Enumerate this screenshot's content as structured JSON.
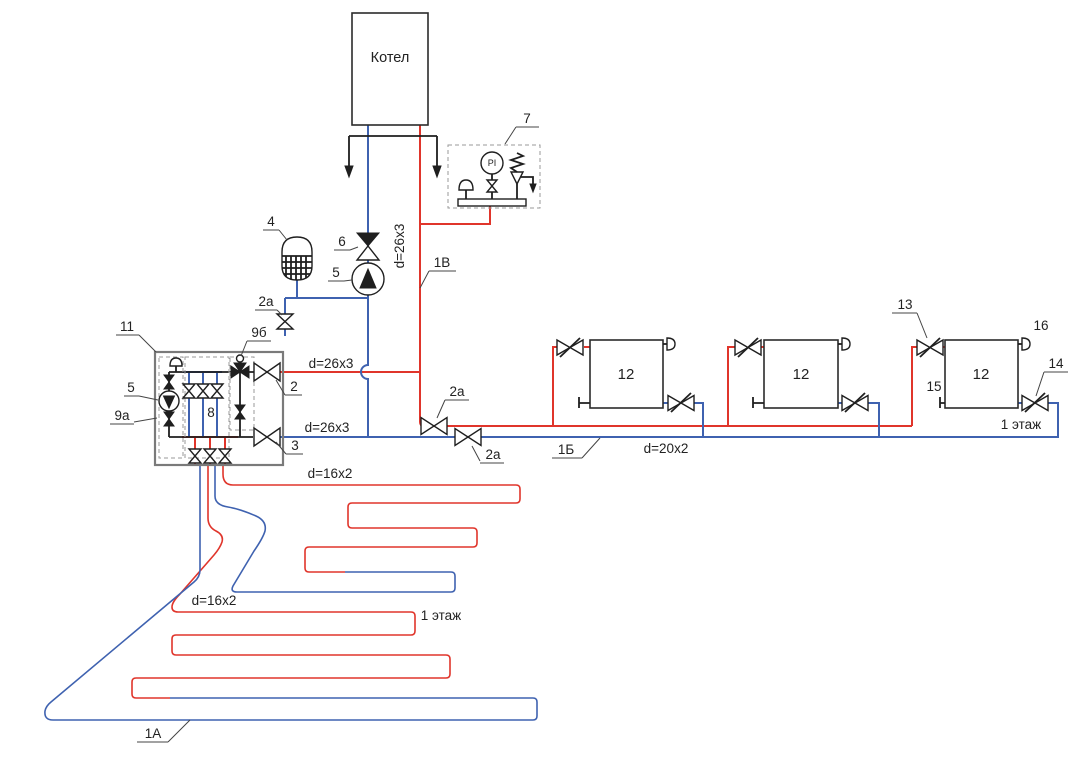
{
  "diagram_title": "Схема отопления с котлом, радиаторами и тёплым полом",
  "colors": {
    "supply_red": "#e0352b",
    "return_blue": "#3f62b0",
    "line_black": "#1f1f1f",
    "box_gray": "#7a7a7a"
  },
  "boiler": {
    "label": "Котел"
  },
  "safety_group": {
    "ref": "7",
    "gauge_label": "PI"
  },
  "equipment": {
    "expansion_tank": "4",
    "check_valve": "6",
    "pump": "5",
    "drain_valve": "2а",
    "mixing_unit": "11",
    "pump_group": "9а",
    "mixing_valve": "9б",
    "manifold": "8",
    "supply_shutoff": "2",
    "return_shutoff": "3",
    "radiator": "12",
    "radiator_supply_valve": "13",
    "radiator_return_valve": "14",
    "radiator_plug": "15",
    "radiator_air_vent": "16"
  },
  "line_refs": {
    "boiler_supply": "1В",
    "radiator_branch": "1Б",
    "floor_loop": "1А"
  },
  "dimensions": {
    "main_pipe": "d=26x3",
    "radiator_pipe": "d=20x2",
    "floor_pipe": "d=16x2"
  },
  "floor_label": "1 этаж"
}
